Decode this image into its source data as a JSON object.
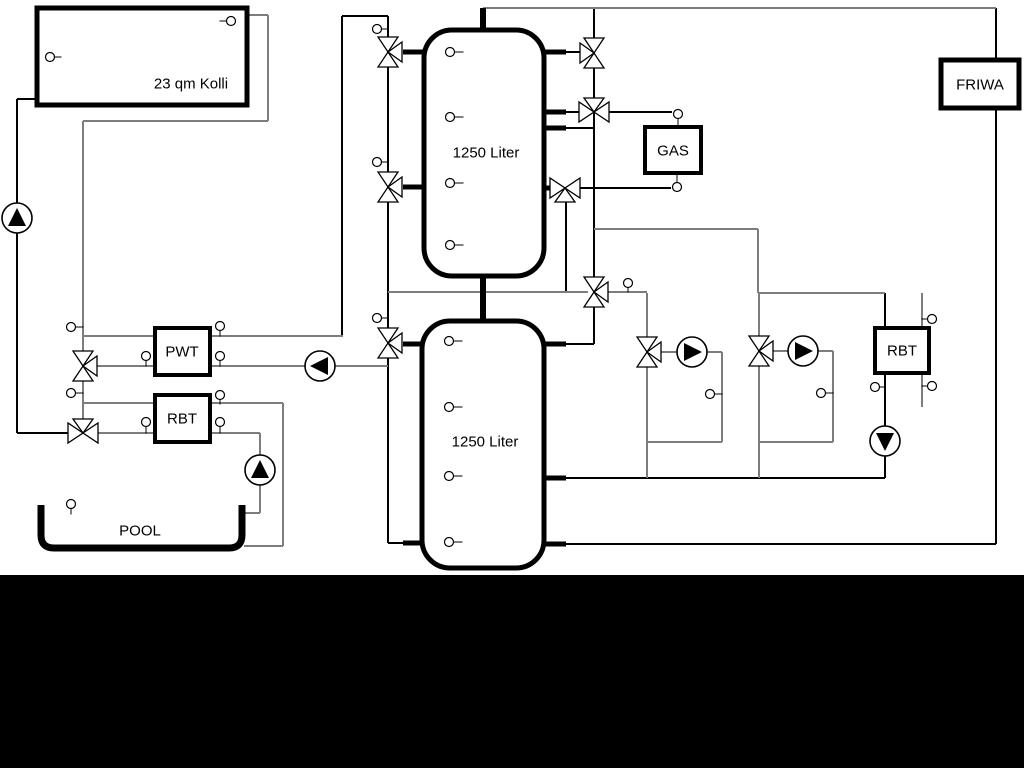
{
  "meta": {
    "width": 1024,
    "height": 768,
    "background": "#ffffff"
  },
  "colors": {
    "k": "#000000",
    "g": "#7d7d7d",
    "fill": "#ffffff",
    "text": "#000000"
  },
  "bottom_bar": {
    "y": 575,
    "h": 193,
    "color": "#000000"
  },
  "tanks": [
    {
      "name": "buffer-tank-1",
      "x": 424,
      "y": 30,
      "w": 120,
      "h": 246,
      "rx": 28,
      "bw": 5,
      "label": "1250 Liter",
      "lx": 486,
      "ly": 153
    },
    {
      "name": "buffer-tank-2",
      "x": 422,
      "y": 321,
      "w": 122,
      "h": 247,
      "rx": 28,
      "bw": 5,
      "label": "1250 Liter",
      "lx": 485,
      "ly": 442
    }
  ],
  "boxes": [
    {
      "name": "solar-collector",
      "x": 37,
      "y": 8,
      "w": 210,
      "h": 97,
      "bw": 5,
      "label": "23 qm Kolli",
      "lx": 191,
      "ly": 84
    },
    {
      "name": "pwt-heat-exchanger",
      "x": 155,
      "y": 328,
      "w": 55,
      "h": 47,
      "bw": 4,
      "label": "PWT",
      "lx": 182,
      "ly": 352
    },
    {
      "name": "rbt-left",
      "x": 155,
      "y": 395,
      "w": 55,
      "h": 47,
      "bw": 4,
      "label": "RBT",
      "lx": 182,
      "ly": 419
    },
    {
      "name": "gas-boiler",
      "x": 645,
      "y": 127,
      "w": 56,
      "h": 46,
      "bw": 4,
      "label": "GAS",
      "lx": 673,
      "ly": 151
    },
    {
      "name": "friwa-station",
      "x": 941,
      "y": 60,
      "w": 78,
      "h": 48,
      "bw": 5,
      "label": "FRIWA",
      "lx": 980,
      "ly": 85
    },
    {
      "name": "rbt-right",
      "x": 875,
      "y": 328,
      "w": 54,
      "h": 45,
      "bw": 4,
      "label": "RBT",
      "lx": 902,
      "ly": 351
    }
  ],
  "pool": {
    "name": "pool",
    "left": 41,
    "right": 242,
    "top": 505,
    "bottom": 548,
    "r": 13,
    "sw": 7,
    "label": "POOL",
    "lx": 140,
    "ly": 531
  },
  "pipes": [
    [
      37,
      99,
      17,
      99,
      "k"
    ],
    [
      17,
      99,
      17,
      433,
      "k"
    ],
    [
      17,
      433,
      70,
      433,
      "k"
    ],
    [
      342,
      16,
      388,
      16,
      "k"
    ],
    [
      342,
      16,
      342,
      336,
      "k"
    ],
    [
      388,
      16,
      388,
      543,
      "k"
    ],
    [
      388,
      543,
      403,
      543,
      "k"
    ],
    [
      594,
      8,
      594,
      344,
      "k"
    ],
    [
      566,
      128,
      594,
      128,
      "k"
    ],
    [
      566,
      52,
      580,
      52,
      "k"
    ],
    [
      566,
      112,
      580,
      112,
      "k"
    ],
    [
      608,
      112,
      672,
      112,
      "k"
    ],
    [
      579,
      188,
      671,
      188,
      "k"
    ],
    [
      566,
      202,
      566,
      292,
      "k"
    ],
    [
      566,
      344,
      594,
      344,
      "k"
    ],
    [
      996,
      8,
      996,
      544,
      "k"
    ],
    [
      996,
      544,
      566,
      544,
      "k"
    ],
    [
      885,
      293,
      885,
      478,
      "k"
    ],
    [
      885,
      478,
      566,
      478,
      "k"
    ],
    [
      483,
      8,
      996,
      8,
      "g"
    ],
    [
      247,
      15,
      268,
      15,
      "g"
    ],
    [
      268,
      15,
      268,
      121,
      "g"
    ],
    [
      268,
      121,
      83,
      121,
      "g"
    ],
    [
      83,
      121,
      83,
      433,
      "g"
    ],
    [
      83,
      336,
      343,
      336,
      "g"
    ],
    [
      97,
      366,
      388,
      366,
      "g"
    ],
    [
      83,
      403,
      283,
      403,
      "g"
    ],
    [
      283,
      403,
      283,
      546,
      "g"
    ],
    [
      283,
      546,
      244,
      546,
      "g"
    ],
    [
      96,
      433,
      260,
      433,
      "g"
    ],
    [
      260,
      433,
      260,
      513,
      "g"
    ],
    [
      260,
      513,
      244,
      513,
      "g"
    ],
    [
      388,
      292,
      588,
      292,
      "g"
    ],
    [
      608,
      292,
      647,
      292,
      "g"
    ],
    [
      594,
      229,
      758,
      229,
      "g"
    ],
    [
      758,
      229,
      758,
      293,
      "g"
    ],
    [
      758,
      293,
      885,
      293,
      "g"
    ],
    [
      647,
      293,
      647,
      478,
      "g"
    ],
    [
      660,
      352,
      678,
      352,
      "g"
    ],
    [
      706,
      352,
      722,
      352,
      "g"
    ],
    [
      722,
      352,
      722,
      442,
      "g"
    ],
    [
      722,
      442,
      647,
      442,
      "g"
    ],
    [
      759,
      293,
      759,
      478,
      "g"
    ],
    [
      772,
      351,
      789,
      351,
      "g"
    ],
    [
      817,
      351,
      833,
      351,
      "g"
    ],
    [
      833,
      351,
      833,
      442,
      "g"
    ],
    [
      833,
      442,
      759,
      442,
      "g"
    ],
    [
      922,
      293,
      922,
      407,
      "g"
    ]
  ],
  "stubs": [
    [
      403,
      52,
      426,
      52,
      5
    ],
    [
      403,
      187,
      426,
      187,
      5
    ],
    [
      543,
      52,
      566,
      52,
      5
    ],
    [
      543,
      112,
      566,
      112,
      5
    ],
    [
      543,
      128,
      566,
      128,
      5
    ],
    [
      543,
      188,
      554,
      188,
      5
    ],
    [
      403,
      344,
      424,
      344,
      5
    ],
    [
      403,
      543,
      424,
      543,
      5
    ],
    [
      544,
      344,
      566,
      344,
      5
    ],
    [
      544,
      478,
      566,
      478,
      5
    ],
    [
      544,
      544,
      566,
      544,
      5
    ],
    [
      483,
      8,
      483,
      33,
      6
    ],
    [
      483,
      273,
      483,
      323,
      6
    ]
  ],
  "valves": [
    [
      388,
      52,
      "v",
      "right"
    ],
    [
      388,
      187,
      "v",
      "right"
    ],
    [
      388,
      343,
      "v",
      "right"
    ],
    [
      83,
      366,
      "v",
      "right"
    ],
    [
      83,
      433,
      "h",
      "top"
    ],
    [
      594,
      53,
      "v",
      "left"
    ],
    [
      594,
      112,
      "h",
      "top"
    ],
    [
      565,
      188,
      "h",
      "bottom"
    ],
    [
      594,
      292,
      "v",
      "right"
    ],
    [
      647,
      352,
      "v",
      "right"
    ],
    [
      759,
      351,
      "v",
      "right"
    ]
  ],
  "pumps": [
    [
      17,
      218,
      "up"
    ],
    [
      320,
      366,
      "left"
    ],
    [
      260,
      470,
      "up"
    ],
    [
      692,
      352,
      "right"
    ],
    [
      803,
      351,
      "right"
    ],
    [
      885,
      441,
      "down"
    ]
  ],
  "sensors": [
    [
      231,
      21,
      "left",
      7
    ],
    [
      50,
      57,
      "right",
      7
    ],
    [
      71,
      327,
      "right",
      8
    ],
    [
      220,
      326,
      "down",
      6
    ],
    [
      146,
      356,
      "down",
      6
    ],
    [
      220,
      356,
      "down",
      6
    ],
    [
      71,
      393,
      "right",
      8
    ],
    [
      220,
      395,
      "down",
      5
    ],
    [
      146,
      422,
      "down",
      7
    ],
    [
      220,
      422,
      "down",
      7
    ],
    [
      71,
      504,
      "down",
      6
    ],
    [
      377,
      29,
      "right",
      7
    ],
    [
      377,
      162,
      "right",
      7
    ],
    [
      377,
      318,
      "right",
      7
    ],
    [
      450,
      52,
      "right",
      9
    ],
    [
      450,
      117,
      "right",
      9
    ],
    [
      450,
      183,
      "right",
      9
    ],
    [
      450,
      245,
      "right",
      9
    ],
    [
      449,
      341,
      "right",
      9
    ],
    [
      449,
      407,
      "right",
      9
    ],
    [
      449,
      476,
      "right",
      9
    ],
    [
      449,
      542,
      "right",
      9
    ],
    [
      628,
      283,
      "down",
      5
    ],
    [
      678,
      114,
      "down",
      9
    ],
    [
      677,
      187,
      "up",
      10
    ],
    [
      710,
      394,
      "right",
      8
    ],
    [
      821,
      393,
      "right",
      8
    ],
    [
      875,
      387,
      "right",
      6
    ],
    [
      932,
      319,
      "left",
      6
    ],
    [
      932,
      386,
      "left",
      6
    ]
  ],
  "label_font_px": 15
}
